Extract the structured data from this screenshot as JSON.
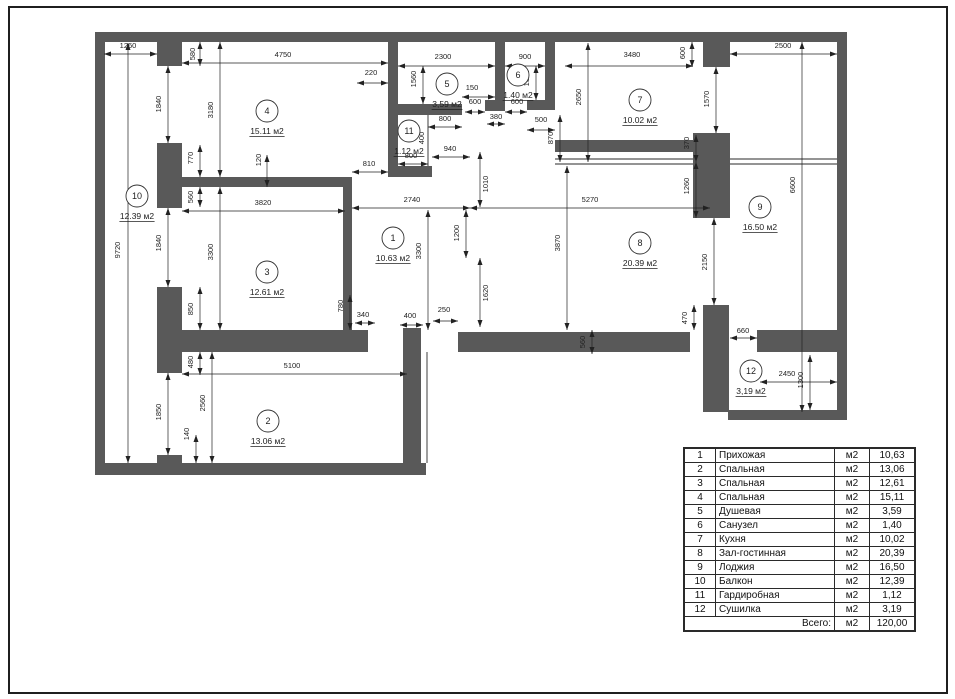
{
  "plan": {
    "wall_color": "#595959",
    "line_color": "#2a2a2a",
    "dim_color": "#222222",
    "walls": [
      [
        95,
        32,
        752,
        10
      ],
      [
        95,
        32,
        10,
        443
      ],
      [
        837,
        32,
        10,
        388
      ],
      [
        95,
        463,
        331,
        12
      ],
      [
        728,
        410,
        119,
        10
      ],
      [
        157,
        42,
        25,
        24
      ],
      [
        157,
        143,
        25,
        65
      ],
      [
        157,
        287,
        25,
        86
      ],
      [
        157,
        455,
        25,
        8
      ],
      [
        182,
        177,
        170,
        10
      ],
      [
        343,
        183,
        9,
        147
      ],
      [
        157,
        330,
        211,
        22
      ],
      [
        403,
        328,
        18,
        147
      ],
      [
        458,
        332,
        232,
        20
      ],
      [
        757,
        330,
        80,
        22
      ],
      [
        388,
        35,
        10,
        142
      ],
      [
        388,
        166,
        44,
        11
      ],
      [
        388,
        104,
        74,
        11
      ],
      [
        485,
        100,
        20,
        11
      ],
      [
        495,
        35,
        10,
        76
      ],
      [
        527,
        100,
        28,
        10
      ],
      [
        545,
        35,
        10,
        75
      ],
      [
        555,
        140,
        142,
        12
      ],
      [
        703,
        42,
        27,
        25
      ],
      [
        693,
        133,
        37,
        85
      ],
      [
        703,
        305,
        26,
        107
      ]
    ],
    "thin_lines": [
      [
        428,
        115,
        428,
        177
      ],
      [
        427,
        352,
        427,
        463
      ],
      [
        555,
        159,
        837,
        159
      ],
      [
        555,
        164,
        837,
        164
      ]
    ],
    "dim_lines": [
      [
        104,
        54,
        157,
        54
      ],
      [
        200,
        42,
        200,
        66
      ],
      [
        182,
        63,
        388,
        63
      ],
      [
        128,
        43,
        128,
        463
      ],
      [
        168,
        66,
        168,
        143
      ],
      [
        220,
        42,
        220,
        177
      ],
      [
        200,
        145,
        200,
        177
      ],
      [
        267,
        155,
        267,
        187
      ],
      [
        352,
        172,
        388,
        172
      ],
      [
        182,
        211,
        345,
        211
      ],
      [
        200,
        187,
        200,
        207
      ],
      [
        168,
        208,
        168,
        287
      ],
      [
        220,
        187,
        220,
        330
      ],
      [
        200,
        287,
        200,
        330
      ],
      [
        200,
        352,
        200,
        375
      ],
      [
        182,
        374,
        407,
        374
      ],
      [
        168,
        373,
        168,
        455
      ],
      [
        212,
        352,
        212,
        463
      ],
      [
        196,
        435,
        196,
        463
      ],
      [
        352,
        208,
        470,
        208
      ],
      [
        470,
        208,
        710,
        208
      ],
      [
        480,
        152,
        480,
        207
      ],
      [
        466,
        210,
        466,
        258
      ],
      [
        480,
        258,
        480,
        327
      ],
      [
        567,
        166,
        567,
        330
      ],
      [
        428,
        210,
        428,
        330
      ],
      [
        350,
        295,
        350,
        330
      ],
      [
        355,
        323,
        375,
        323
      ],
      [
        400,
        325,
        423,
        325
      ],
      [
        433,
        321,
        458,
        321
      ],
      [
        592,
        330,
        592,
        354
      ],
      [
        694,
        305,
        694,
        330
      ],
      [
        730,
        338,
        757,
        338
      ],
      [
        760,
        382,
        837,
        382
      ],
      [
        810,
        355,
        810,
        410
      ],
      [
        692,
        42,
        692,
        67
      ],
      [
        716,
        67,
        716,
        133
      ],
      [
        696,
        135,
        696,
        162
      ],
      [
        696,
        162,
        696,
        218
      ],
      [
        714,
        218,
        714,
        305
      ],
      [
        802,
        42,
        802,
        412
      ],
      [
        730,
        54,
        837,
        54
      ],
      [
        565,
        66,
        693,
        66
      ],
      [
        398,
        66,
        495,
        66
      ],
      [
        505,
        66,
        545,
        66
      ],
      [
        423,
        66,
        423,
        104
      ],
      [
        536,
        66,
        536,
        100
      ],
      [
        357,
        83,
        388,
        83
      ],
      [
        462,
        97,
        495,
        97
      ],
      [
        465,
        112,
        485,
        112
      ],
      [
        505,
        112,
        527,
        112
      ],
      [
        428,
        127,
        462,
        127
      ],
      [
        487,
        124,
        505,
        124
      ],
      [
        527,
        130,
        555,
        130
      ],
      [
        560,
        115,
        560,
        162
      ],
      [
        588,
        43,
        588,
        162
      ],
      [
        398,
        164,
        428,
        164
      ],
      [
        432,
        157,
        470,
        157
      ]
    ],
    "dim_labels": [
      {
        "t": "1260",
        "x": 128,
        "y": 48,
        "r": 0
      },
      {
        "t": "580",
        "x": 195,
        "y": 54,
        "r": 1
      },
      {
        "t": "4750",
        "x": 283,
        "y": 57,
        "r": 0
      },
      {
        "t": "9720",
        "x": 120,
        "y": 250,
        "r": 1
      },
      {
        "t": "1840",
        "x": 161,
        "y": 104,
        "r": 1
      },
      {
        "t": "3180",
        "x": 213,
        "y": 110,
        "r": 1
      },
      {
        "t": "770",
        "x": 193,
        "y": 158,
        "r": 1
      },
      {
        "t": "120",
        "x": 261,
        "y": 160,
        "r": 1
      },
      {
        "t": "810",
        "x": 369,
        "y": 166,
        "r": 0
      },
      {
        "t": "3820",
        "x": 263,
        "y": 205,
        "r": 0
      },
      {
        "t": "560",
        "x": 193,
        "y": 197,
        "r": 1
      },
      {
        "t": "1840",
        "x": 161,
        "y": 243,
        "r": 1
      },
      {
        "t": "3300",
        "x": 213,
        "y": 252,
        "r": 1
      },
      {
        "t": "850",
        "x": 193,
        "y": 309,
        "r": 1
      },
      {
        "t": "480",
        "x": 193,
        "y": 362,
        "r": 1
      },
      {
        "t": "5100",
        "x": 292,
        "y": 368,
        "r": 0
      },
      {
        "t": "1850",
        "x": 161,
        "y": 412,
        "r": 1
      },
      {
        "t": "2560",
        "x": 205,
        "y": 403,
        "r": 1
      },
      {
        "t": "140",
        "x": 189,
        "y": 434,
        "r": 1
      },
      {
        "t": "2740",
        "x": 412,
        "y": 202,
        "r": 0
      },
      {
        "t": "5270",
        "x": 590,
        "y": 202,
        "r": 0
      },
      {
        "t": "1010",
        "x": 488,
        "y": 184,
        "r": 1
      },
      {
        "t": "1200",
        "x": 459,
        "y": 233,
        "r": 1
      },
      {
        "t": "1620",
        "x": 488,
        "y": 293,
        "r": 1
      },
      {
        "t": "3870",
        "x": 560,
        "y": 243,
        "r": 1
      },
      {
        "t": "3300",
        "x": 421,
        "y": 251,
        "r": 1
      },
      {
        "t": "780",
        "x": 343,
        "y": 306,
        "r": 1
      },
      {
        "t": "340",
        "x": 363,
        "y": 317,
        "r": 0
      },
      {
        "t": "400",
        "x": 410,
        "y": 318,
        "r": 0
      },
      {
        "t": "250",
        "x": 444,
        "y": 312,
        "r": 0
      },
      {
        "t": "560",
        "x": 585,
        "y": 342,
        "r": 1
      },
      {
        "t": "470",
        "x": 687,
        "y": 318,
        "r": 1
      },
      {
        "t": "660",
        "x": 743,
        "y": 333,
        "r": 0
      },
      {
        "t": "2450",
        "x": 787,
        "y": 376,
        "r": 0
      },
      {
        "t": "1300",
        "x": 803,
        "y": 380,
        "r": 1
      },
      {
        "t": "600",
        "x": 685,
        "y": 53,
        "r": 1
      },
      {
        "t": "1570",
        "x": 709,
        "y": 99,
        "r": 1
      },
      {
        "t": "370",
        "x": 689,
        "y": 143,
        "r": 1
      },
      {
        "t": "1260",
        "x": 689,
        "y": 186,
        "r": 1
      },
      {
        "t": "2150",
        "x": 707,
        "y": 262,
        "r": 1
      },
      {
        "t": "6600",
        "x": 795,
        "y": 185,
        "r": 1
      },
      {
        "t": "2500",
        "x": 783,
        "y": 48,
        "r": 0
      },
      {
        "t": "3480",
        "x": 632,
        "y": 57,
        "r": 0
      },
      {
        "t": "2300",
        "x": 443,
        "y": 59,
        "r": 0
      },
      {
        "t": "900",
        "x": 525,
        "y": 59,
        "r": 0
      },
      {
        "t": "1560",
        "x": 416,
        "y": 79,
        "r": 1
      },
      {
        "t": "1560",
        "x": 529,
        "y": 78,
        "r": 1
      },
      {
        "t": "220",
        "x": 371,
        "y": 75,
        "r": 0
      },
      {
        "t": "150",
        "x": 472,
        "y": 90,
        "r": 0
      },
      {
        "t": "600",
        "x": 475,
        "y": 104,
        "r": 0
      },
      {
        "t": "600",
        "x": 517,
        "y": 104,
        "r": 0
      },
      {
        "t": "800",
        "x": 445,
        "y": 121,
        "r": 0
      },
      {
        "t": "380",
        "x": 496,
        "y": 119,
        "r": 0
      },
      {
        "t": "500",
        "x": 541,
        "y": 122,
        "r": 0
      },
      {
        "t": "870",
        "x": 553,
        "y": 138,
        "r": 1
      },
      {
        "t": "2650",
        "x": 581,
        "y": 97,
        "r": 1
      },
      {
        "t": "400",
        "x": 424,
        "y": 138,
        "r": 1
      },
      {
        "t": "800",
        "x": 411,
        "y": 158,
        "r": 0
      },
      {
        "t": "940",
        "x": 450,
        "y": 151,
        "r": 0
      }
    ],
    "rooms": [
      {
        "n": "1",
        "area": "10.63 м2",
        "cx": 393,
        "cy": 238
      },
      {
        "n": "2",
        "area": "13.06 м2",
        "cx": 268,
        "cy": 421
      },
      {
        "n": "3",
        "area": "12.61 м2",
        "cx": 267,
        "cy": 272
      },
      {
        "n": "4",
        "area": "15.11 м2",
        "cx": 267,
        "cy": 111
      },
      {
        "n": "5",
        "area": "3,59 м2",
        "cx": 447,
        "cy": 84
      },
      {
        "n": "6",
        "area": "1.40 м2",
        "cx": 518,
        "cy": 75
      },
      {
        "n": "7",
        "area": "10.02 м2",
        "cx": 640,
        "cy": 100
      },
      {
        "n": "8",
        "area": "20.39 м2",
        "cx": 640,
        "cy": 243
      },
      {
        "n": "9",
        "area": "16.50 м2",
        "cx": 760,
        "cy": 207
      },
      {
        "n": "10",
        "area": "12.39 м2",
        "cx": 137,
        "cy": 196
      },
      {
        "n": "11",
        "area": "1.12 м2",
        "cx": 409,
        "cy": 131
      },
      {
        "n": "12",
        "area": "3,19 м2",
        "cx": 751,
        "cy": 371
      }
    ]
  },
  "legend_table": {
    "rows": [
      {
        "num": "1",
        "name": "Прихожая",
        "unit": "м2",
        "area": "10,63"
      },
      {
        "num": "2",
        "name": "Спальная",
        "unit": "м2",
        "area": "13,06"
      },
      {
        "num": "3",
        "name": "Спальная",
        "unit": "м2",
        "area": "12,61"
      },
      {
        "num": "4",
        "name": "Спальная",
        "unit": "м2",
        "area": "15,11"
      },
      {
        "num": "5",
        "name": "Душевая",
        "unit": "м2",
        "area": "3,59"
      },
      {
        "num": "6",
        "name": "Санузел",
        "unit": "м2",
        "area": "1,40"
      },
      {
        "num": "7",
        "name": "Кухня",
        "unit": "м2",
        "area": "10,02"
      },
      {
        "num": "8",
        "name": "Зал-гостинная",
        "unit": "м2",
        "area": "20,39"
      },
      {
        "num": "9",
        "name": "Лоджия",
        "unit": "м2",
        "area": "16,50"
      },
      {
        "num": "10",
        "name": "Балкон",
        "unit": "м2",
        "area": "12,39"
      },
      {
        "num": "11",
        "name": "Гардиробная",
        "unit": "м2",
        "area": "1,12"
      },
      {
        "num": "12",
        "name": "Сушилка",
        "unit": "м2",
        "area": "3,19"
      }
    ],
    "total": {
      "label": "Всего:",
      "unit": "м2",
      "area": "120,00"
    }
  }
}
